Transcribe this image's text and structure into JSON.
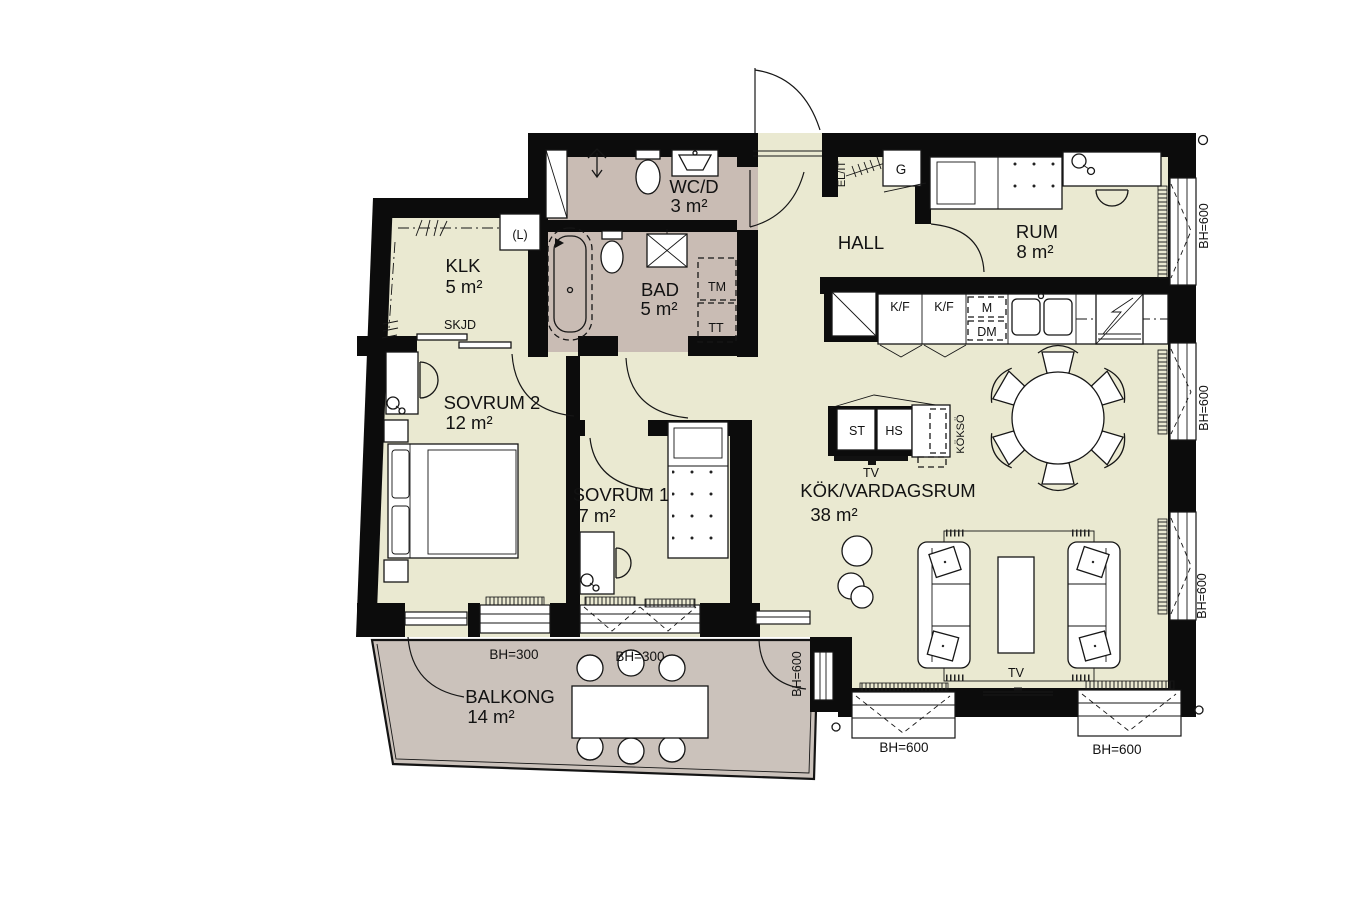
{
  "plan": {
    "type": "apartment-floor-plan",
    "rooms": [
      {
        "id": "wcd",
        "name": "WC/D",
        "area": "3 m²"
      },
      {
        "id": "bad",
        "name": "BAD",
        "area": "5 m²"
      },
      {
        "id": "klk",
        "name": "KLK",
        "area": "5 m²"
      },
      {
        "id": "hall",
        "name": "HALL",
        "area": ""
      },
      {
        "id": "rum",
        "name": "RUM",
        "area": "8 m²"
      },
      {
        "id": "sovrum2",
        "name": "SOVRUM 2",
        "area": "12 m²"
      },
      {
        "id": "sovrum1",
        "name": "SOVRUM 1",
        "area": "7 m²"
      },
      {
        "id": "kok",
        "name": "KÖK/VARDAGSRUM",
        "area": "38 m²"
      },
      {
        "id": "balkong",
        "name": "BALKONG",
        "area": "14 m²"
      }
    ],
    "labels": {
      "skjd": "SKJD",
      "linen": "(L)",
      "tm": "TM",
      "tt": "TT",
      "garderob": "G",
      "el_it": "EL/IT",
      "kf_1": "K/F",
      "kf_2": "K/F",
      "micro": "M",
      "dm": "DM",
      "st": "ST",
      "hs": "HS",
      "tv_bench": "TV",
      "kokso": "KÖKSÖ",
      "tv_wall": "TV"
    },
    "windows": {
      "bh300_1": "BH=300",
      "bh300_2": "BH=300",
      "bh600_balcony": "BH=600",
      "bh600_south_1": "BH=600",
      "bh600_south_2": "BH=600",
      "bh600_east_1": "BH=600",
      "bh600_east_2": "BH=600",
      "bh600_east_3": "BH=600"
    },
    "colors": {
      "floor": "#eae9d1",
      "wet": "#c9bcb4",
      "balcony": "#cbc2bb",
      "wall": "#0c0c0c"
    }
  }
}
